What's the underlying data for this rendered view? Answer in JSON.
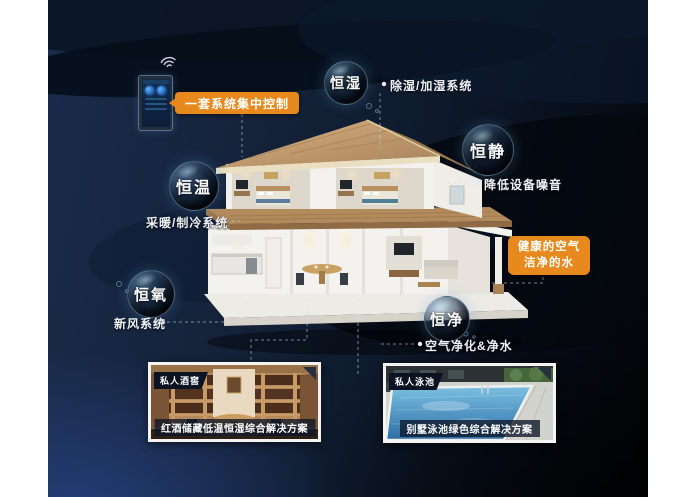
{
  "infographic": {
    "control_label": "一套系统集中控制",
    "highlight_box": {
      "line1": "健康的空气",
      "line2": "洁净的水"
    },
    "features": [
      {
        "name": "恒湿",
        "annotation": "除湿/加湿系统"
      },
      {
        "name": "恒静",
        "annotation": "降低设备噪音"
      },
      {
        "name": "恒温",
        "annotation": "采暖/制冷系统"
      },
      {
        "name": "恒氧",
        "annotation": "新风系统"
      },
      {
        "name": "恒净",
        "annotation": "空气净化&净水"
      }
    ],
    "cards": [
      {
        "tag": "私人酒窖",
        "caption": "红酒储藏低温恒湿综合解决方案"
      },
      {
        "tag": "私人泳池",
        "caption": "别墅泳池绿色综合解决方案"
      }
    ],
    "colors": {
      "accent_orange": "#E8891D",
      "deep_blue_glow": "#2C4C98",
      "background_navy": "#0E1A2C",
      "bubble_rim": "#9FD4E6"
    }
  }
}
